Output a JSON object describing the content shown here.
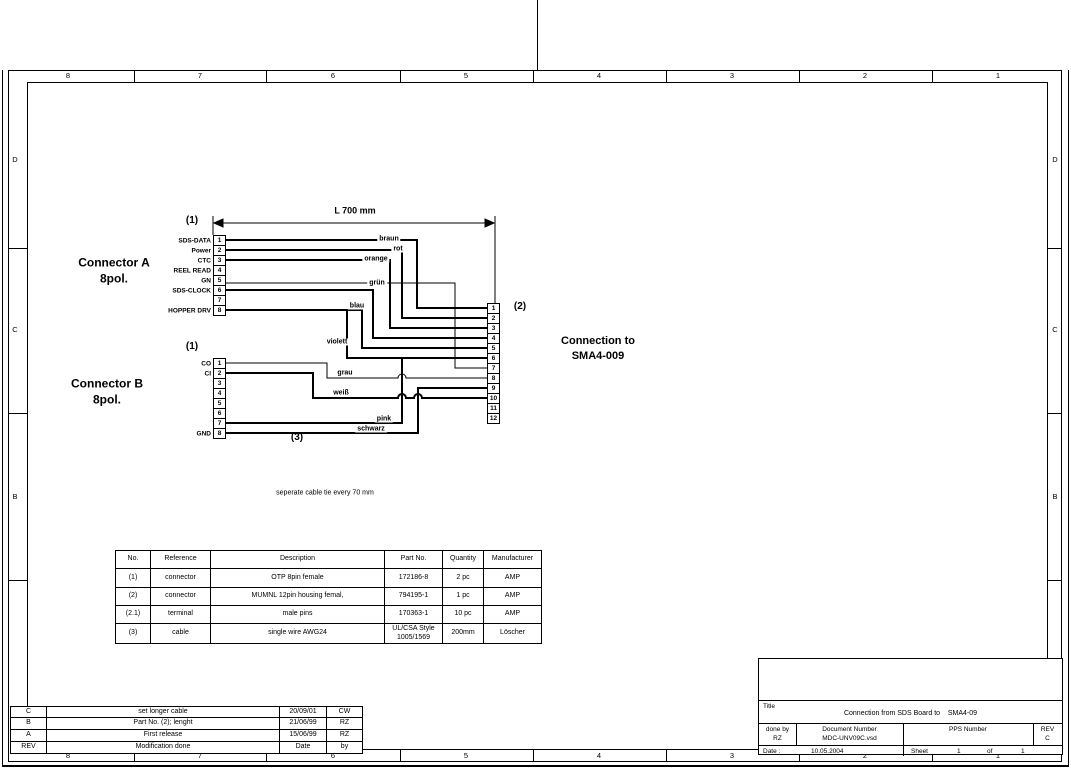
{
  "ink": "#000000",
  "paper": "#ffffff",
  "frame": {
    "top_zones": [
      "8",
      "7",
      "6",
      "5",
      "4",
      "3",
      "2",
      "1"
    ],
    "bottom_zones": [
      "8",
      "7",
      "6",
      "5",
      "4",
      "3",
      "2",
      "1"
    ],
    "left_zones": [
      "D",
      "C",
      "B"
    ],
    "right_zones": [
      "D",
      "C",
      "B",
      "A"
    ]
  },
  "diagram": {
    "dimension_label": "L 700 mm",
    "note": "seperate cable tie every 70 mm",
    "connection_label_line1": "Connection to",
    "connection_label_line2": "SMA4-009",
    "cable_ref": "(3)",
    "connector_a": {
      "ref": "(1)",
      "title": "Connector A",
      "subtitle": "8pol.",
      "pins": [
        {
          "no": "1",
          "label": "SDS-DATA"
        },
        {
          "no": "2",
          "label": "Power"
        },
        {
          "no": "3",
          "label": "CTC"
        },
        {
          "no": "4",
          "label": "REEL READ"
        },
        {
          "no": "5",
          "label": "GN"
        },
        {
          "no": "6",
          "label": "SDS-CLOCK"
        },
        {
          "no": "7",
          "label": ""
        },
        {
          "no": "8",
          "label": "HOPPER DRV"
        }
      ]
    },
    "connector_b": {
      "ref": "(1)",
      "title": "Connector B",
      "subtitle": "8pol.",
      "pins": [
        {
          "no": "1",
          "label": "CO"
        },
        {
          "no": "2",
          "label": "CI"
        },
        {
          "no": "3",
          "label": ""
        },
        {
          "no": "4",
          "label": ""
        },
        {
          "no": "5",
          "label": ""
        },
        {
          "no": "6",
          "label": ""
        },
        {
          "no": "7",
          "label": ""
        },
        {
          "no": "8",
          "label": "GND"
        }
      ]
    },
    "connector_sma": {
      "ref": "(2)",
      "pins": [
        {
          "no": "1"
        },
        {
          "no": "2"
        },
        {
          "no": "3"
        },
        {
          "no": "4"
        },
        {
          "no": "5"
        },
        {
          "no": "6"
        },
        {
          "no": "7"
        },
        {
          "no": "8"
        },
        {
          "no": "9"
        },
        {
          "no": "10"
        },
        {
          "no": "11"
        },
        {
          "no": "12"
        }
      ]
    },
    "wires": [
      {
        "id": "braun",
        "color_label": "braun"
      },
      {
        "id": "rot",
        "color_label": "rot"
      },
      {
        "id": "orange",
        "color_label": "orange"
      },
      {
        "id": "gn",
        "color_label": ""
      },
      {
        "id": "gruen",
        "color_label": "grün"
      },
      {
        "id": "blau",
        "color_label": "blau"
      },
      {
        "id": "violett",
        "color_label": "violett"
      },
      {
        "id": "grau",
        "color_label": "grau"
      },
      {
        "id": "weiss",
        "color_label": "weiß"
      },
      {
        "id": "pink",
        "color_label": "pink"
      },
      {
        "id": "schwarz",
        "color_label": "schwarz"
      }
    ]
  },
  "parts_table": {
    "headers": [
      "No.",
      "Reference",
      "Description",
      "Part No.",
      "Quantity",
      "Manufacturer"
    ],
    "rows": [
      [
        "(1)",
        "connector",
        "OTP 8pin female",
        "172186-8",
        "2 pc",
        "AMP"
      ],
      [
        "(2)",
        "connector",
        "MUMNL 12pin housing femal,",
        "794195-1",
        "1 pc",
        "AMP"
      ],
      [
        "(2.1)",
        "terminal",
        "male pins",
        "170363-1",
        "10 pc",
        "AMP"
      ],
      [
        "(3)",
        "cable",
        "single wire AWG24",
        "UL/CSA Style\n1005/1569",
        "200mm",
        "Löscher"
      ]
    ]
  },
  "revision_table": {
    "rows": [
      [
        "C",
        "set longer cable",
        "20/09/01",
        "CW"
      ],
      [
        "B",
        "Part No. (2); lenght",
        "21/06/99",
        "RZ"
      ],
      [
        "A",
        "First release",
        "15/06/99",
        "RZ"
      ]
    ],
    "footer": [
      "REV",
      "Modification done",
      "Date",
      "by"
    ]
  },
  "title_block": {
    "title_label": "Title",
    "title_1": "Connection from SDS Board to",
    "title_2": "SMA4-09",
    "done_by_label": "done by",
    "done_by": "RZ",
    "doc_label": "Document Number",
    "doc": "MDC-UNV09C.vsd",
    "pps_label": "PPS Number",
    "rev_label": "REV",
    "rev": "C",
    "date_label": "Date :",
    "date": "10.05.2004",
    "sheet_label": "Sheet",
    "sheet_no": "1",
    "of_label": "of",
    "sheet_total": "1"
  }
}
